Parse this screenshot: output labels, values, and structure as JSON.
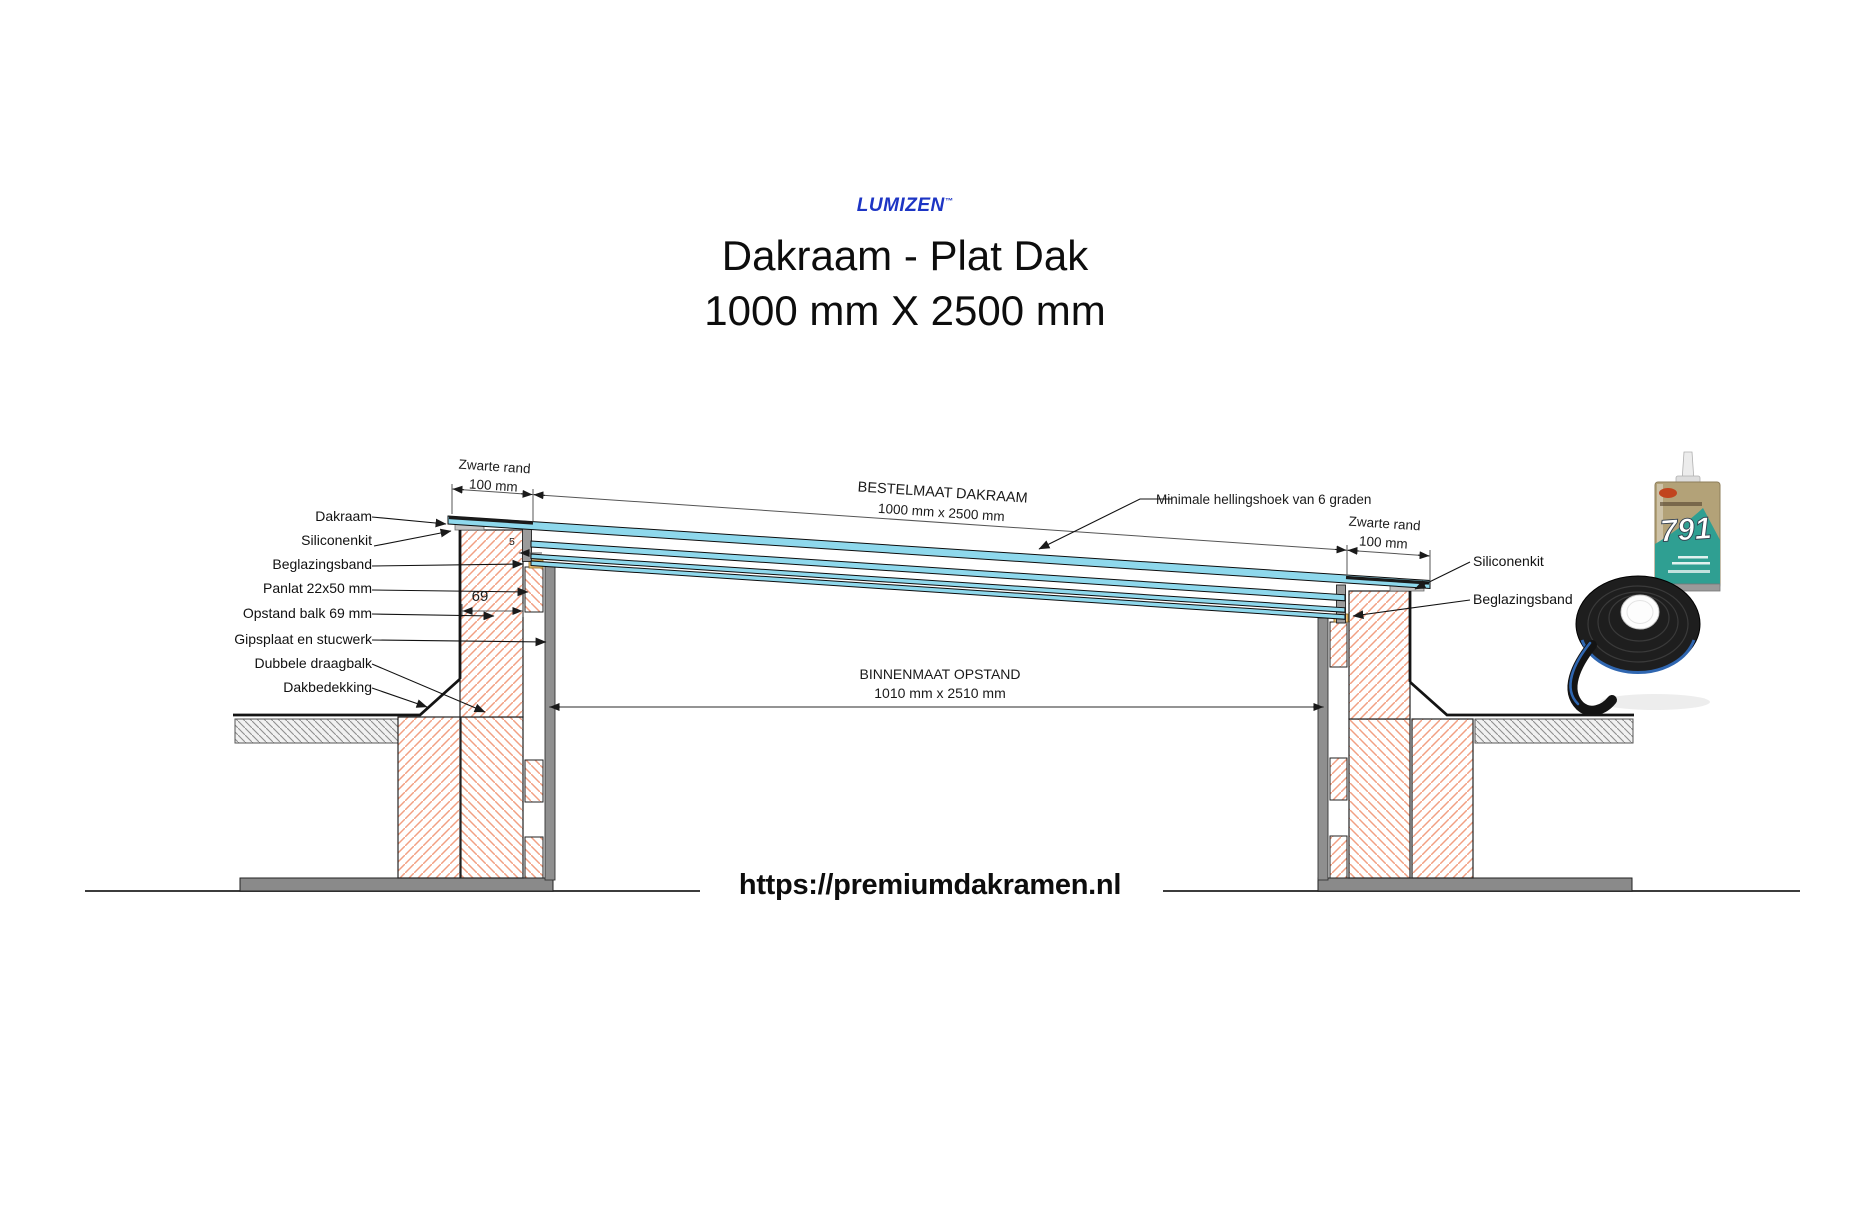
{
  "header": {
    "logo": "LUMIZEN",
    "logo_tm": "™",
    "title_line1": "Dakraam - Plat Dak",
    "title_line2": "1000 mm X 2500 mm"
  },
  "labels_left": [
    "Dakraam",
    "Siliconenkit",
    "Beglazingsband",
    "Panlat 22x50 mm",
    "Opstand balk 69 mm",
    "Gipsplaat en stucwerk",
    "Dubbele draagbalk",
    "Dakbedekking"
  ],
  "labels_right": [
    "Siliconenkit",
    "Beglazingsband"
  ],
  "dimensions": {
    "zwarte_rand_left": {
      "line1": "Zwarte rand",
      "line2": "100 mm"
    },
    "zwarte_rand_right": {
      "line1": "Zwarte rand",
      "line2": "100 mm"
    },
    "bestelmaat": {
      "line1": "BESTELMAAT DAKRAAM",
      "line2": "1000 mm x 2500 mm"
    },
    "binnenmaat": {
      "line1": "BINNENMAAT OPSTAND",
      "line2": "1010 mm x 2510 mm"
    },
    "opstand_width": "69",
    "glass_gap": "5",
    "slope_note": "Minimale hellingshoek van 6 graden"
  },
  "products": {
    "sealant_number": "791"
  },
  "footer": {
    "url": "https://premiumdakramen.nl"
  },
  "colors": {
    "glass_blue": "#8ed8ec",
    "wall_hatch_orange": "#f2a083",
    "logo_blue": "#1d35c4",
    "sealant_teal": "#2f9f92",
    "tape_blue": "#2f66b0",
    "gray_fill": "#8f8f8f"
  }
}
